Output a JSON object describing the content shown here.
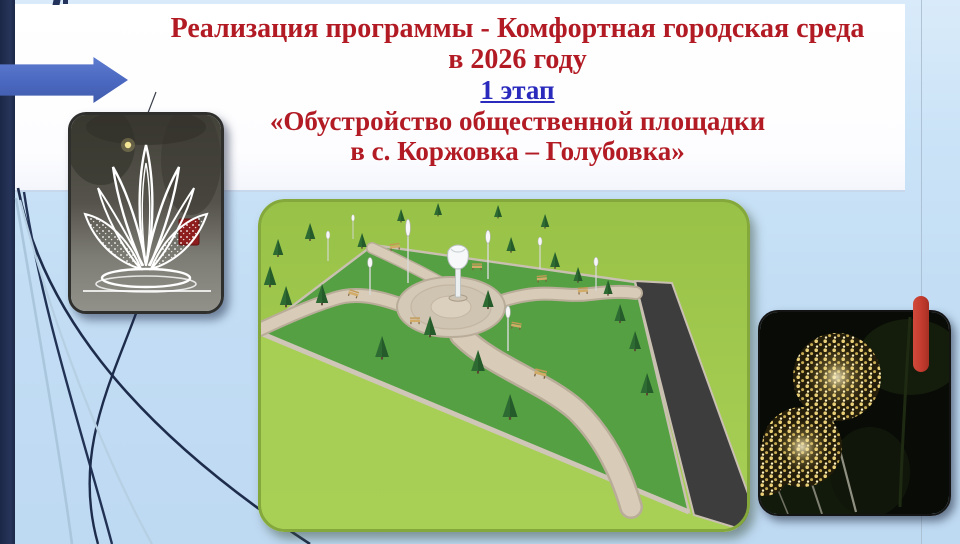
{
  "header": {
    "title_line1": "Реализация программы - Комфортная городская среда",
    "title_line2": "в 2026 году",
    "stage_label": "1 этап",
    "subtitle_line1": "«Обустройство общественной площадки",
    "subtitle_line2": "в с. Коржовка – Голубовка»"
  },
  "figures": {
    "left": "winter-light-sculpture-photo",
    "center": "park-plaza-3d-render",
    "right": "golden-dandelion-lights-photo"
  },
  "colors": {
    "title_red": "#b21b24",
    "stage_blue": "#2a2abd",
    "accent_navy": "#22304f",
    "arrow_blue": "#4a68c0",
    "marker_red": "#c23b2e",
    "background_blue": "#c2ddf4",
    "header_white": "#fdfdff"
  }
}
